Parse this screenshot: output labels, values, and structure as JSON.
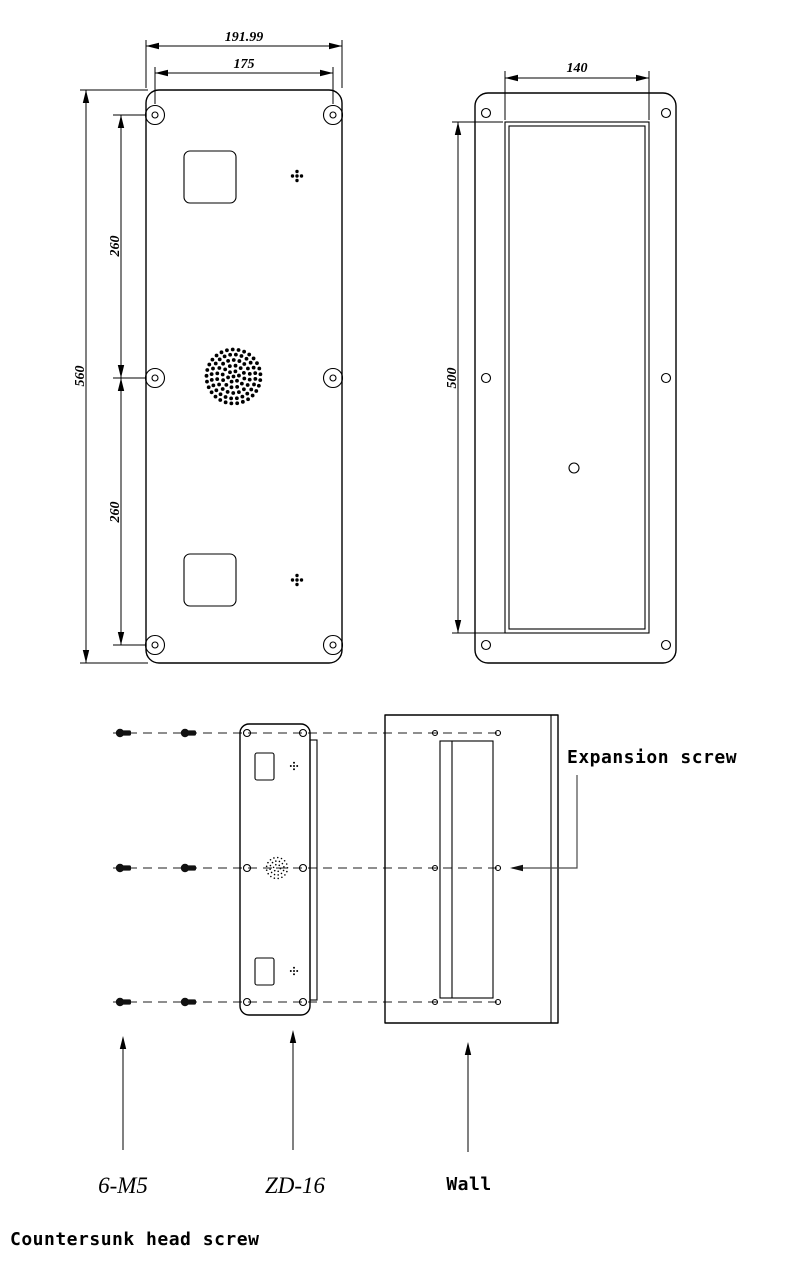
{
  "drawing": {
    "front_view": {
      "dim_overall_width": "191.99",
      "dim_mount_width": "175",
      "dim_overall_height": "560",
      "dim_mount_upper": "260",
      "dim_mount_lower": "260"
    },
    "side_view": {
      "dim_opening_width": "140",
      "dim_opening_height": "500"
    },
    "install_view": {
      "expansion_screw_label": "Expansion screw",
      "screw_spec_label": "6-M5",
      "model_label": "ZD-16",
      "wall_label": "Wall",
      "countersunk_label": "Countersunk head screw"
    },
    "colors": {
      "line": "#000000",
      "dashed_line": "#4a4a4a",
      "background": "#ffffff"
    }
  }
}
